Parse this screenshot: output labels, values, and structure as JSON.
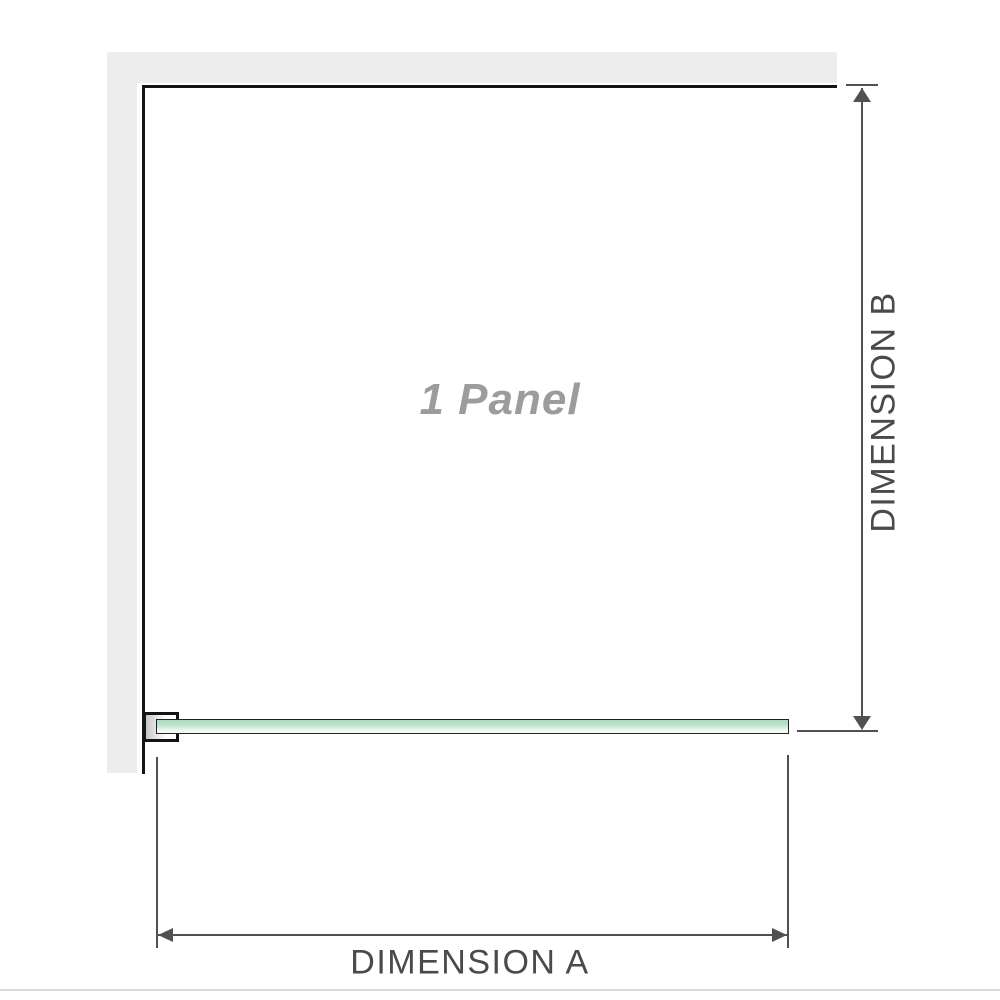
{
  "diagram": {
    "title_hint": "shower panel dimension diagram",
    "panel_label": "1 Panel",
    "dimension_a": {
      "label": "DIMENSION A",
      "orientation": "horizontal",
      "measures": "glass panel width"
    },
    "dimension_b": {
      "label": "DIMENSION B",
      "orientation": "vertical",
      "measures": "panel depth from wall"
    },
    "parts": {
      "wall": "L-shaped wall (top and left)",
      "clamp": "wall-mount glass clamp",
      "glass": "single glass panel (top view)"
    }
  },
  "colors": {
    "wall": "#ededed",
    "wall_edge": "#141414",
    "dimension_line": "#515151",
    "label_gray": "#4a4a4d",
    "panel_label_gray": "#9c9c9c",
    "separator": "#d9d9d9",
    "glass_border": "#222222",
    "glass_green": "#b5e0c6"
  }
}
